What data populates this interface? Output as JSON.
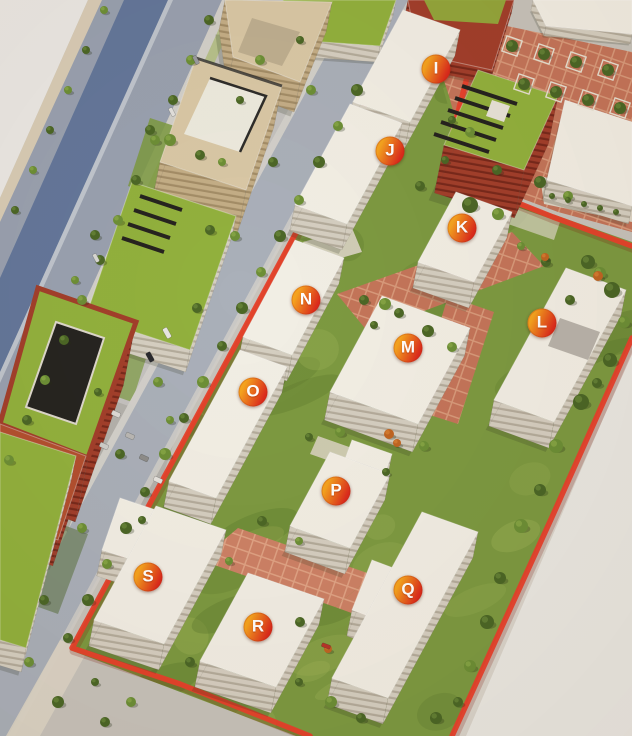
{
  "canvas": {
    "width": 632,
    "height": 736
  },
  "site_map": {
    "markers": [
      {
        "label": "I",
        "x": 436,
        "y": 69
      },
      {
        "label": "J",
        "x": 390,
        "y": 151
      },
      {
        "label": "K",
        "x": 462,
        "y": 228
      },
      {
        "label": "L",
        "x": 542,
        "y": 323
      },
      {
        "label": "M",
        "x": 408,
        "y": 348
      },
      {
        "label": "N",
        "x": 306,
        "y": 300
      },
      {
        "label": "O",
        "x": 253,
        "y": 392
      },
      {
        "label": "P",
        "x": 336,
        "y": 491
      },
      {
        "label": "Q",
        "x": 408,
        "y": 590
      },
      {
        "label": "R",
        "x": 258,
        "y": 627
      },
      {
        "label": "S",
        "x": 148,
        "y": 577
      }
    ],
    "marker_style": {
      "diameter_px": 29,
      "gradient_start": "#f5a31e",
      "gradient_end": "#dc2a1c",
      "text_color": "#ffffff"
    },
    "boundary": {
      "color": "#e8402b",
      "width_px": 5.5
    }
  },
  "palette": {
    "margin": "#eae8e4",
    "margin_edge": "#d8ccb6",
    "margin_inner": "#d9d4cc",
    "ground": "#c7c3bc",
    "road": "#99a1b0",
    "road_dark": "#64779b",
    "lane_line": "#dfe3e8",
    "sidewalk": "#d2d0cb",
    "sidewalk_warm": "#dcd5c6",
    "concrete": "#c4c2c0",
    "street": "#aab0ba",
    "grass": "#7d9a41",
    "grass_dark": "#5d7a2e",
    "grass_light": "#9fb457",
    "plaza": "#c4755a",
    "plaza_light": "#d89a7b",
    "plaza2": "#cd8266",
    "plaza2_light": "#e0a385",
    "white_roof": "#f2efe6",
    "white_side": "#d5cfc2",
    "window_line": "#b4ac9c",
    "tan_roof": "#d9c8a6",
    "tan_side": "#c4ae87",
    "tan_line": "#a38d67",
    "brick": "#a23f2b",
    "brick_line": "#78291b",
    "brick_roof": "#b3502f",
    "green_roof": "#92b13d",
    "solar": "#26231f",
    "tree_dark": "#4c6726",
    "tree_mid": "#6d8f36",
    "tree_autumn": "#c06522",
    "penthouse": "#eceadf",
    "roof_deck": "#b9b4ac",
    "shadow": "rgba(45,48,28,0.20)"
  }
}
